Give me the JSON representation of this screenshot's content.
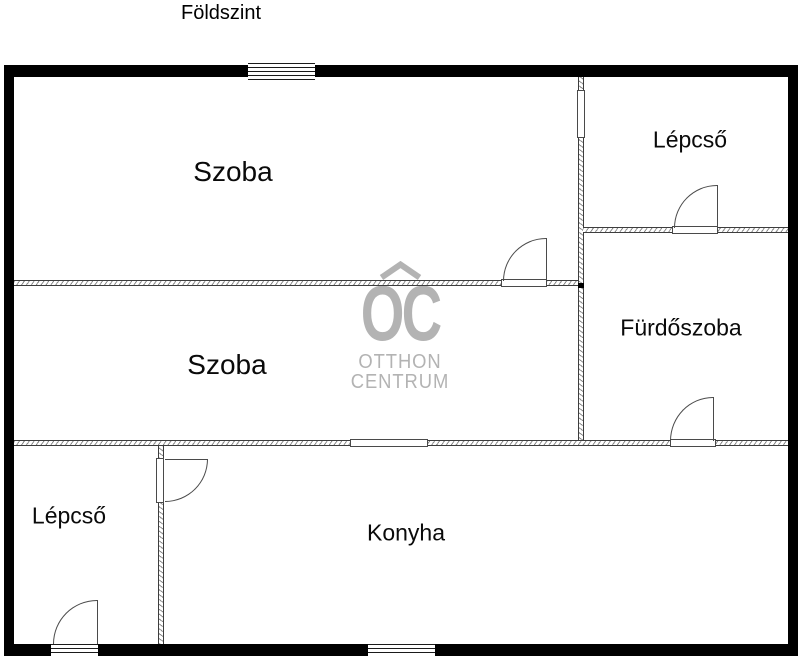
{
  "title": "Földszint",
  "rooms": [
    {
      "id": "szoba-1",
      "label": "Szoba"
    },
    {
      "id": "szoba-2",
      "label": "Szoba"
    },
    {
      "id": "lepcso-upper",
      "label": "Lépcső"
    },
    {
      "id": "furdoszoba",
      "label": "Fürdőszoba"
    },
    {
      "id": "konyha",
      "label": "Konyha"
    },
    {
      "id": "lepcso-lower",
      "label": "Lépcső"
    }
  ],
  "logo": {
    "monogram": "OC",
    "line1": "OTTHON",
    "line2": "CENTRUM",
    "color": "#b3b3b3",
    "icon": "roof-chevron-icon"
  },
  "colors": {
    "outer_wall": "#000000",
    "background": "#ffffff",
    "line": "#4a4a4a",
    "watermark": "#b3b3b3"
  },
  "elements": {
    "windows": [
      "top-wall-window",
      "bottom-wall-window"
    ],
    "doors": [
      "szoba-divider-door",
      "lepcso-upper-door",
      "furdoszoba-door",
      "konyha-door",
      "lepcso-lower-exit-door",
      "hall-doorway-opening",
      "szoba-konyha-passage"
    ]
  }
}
